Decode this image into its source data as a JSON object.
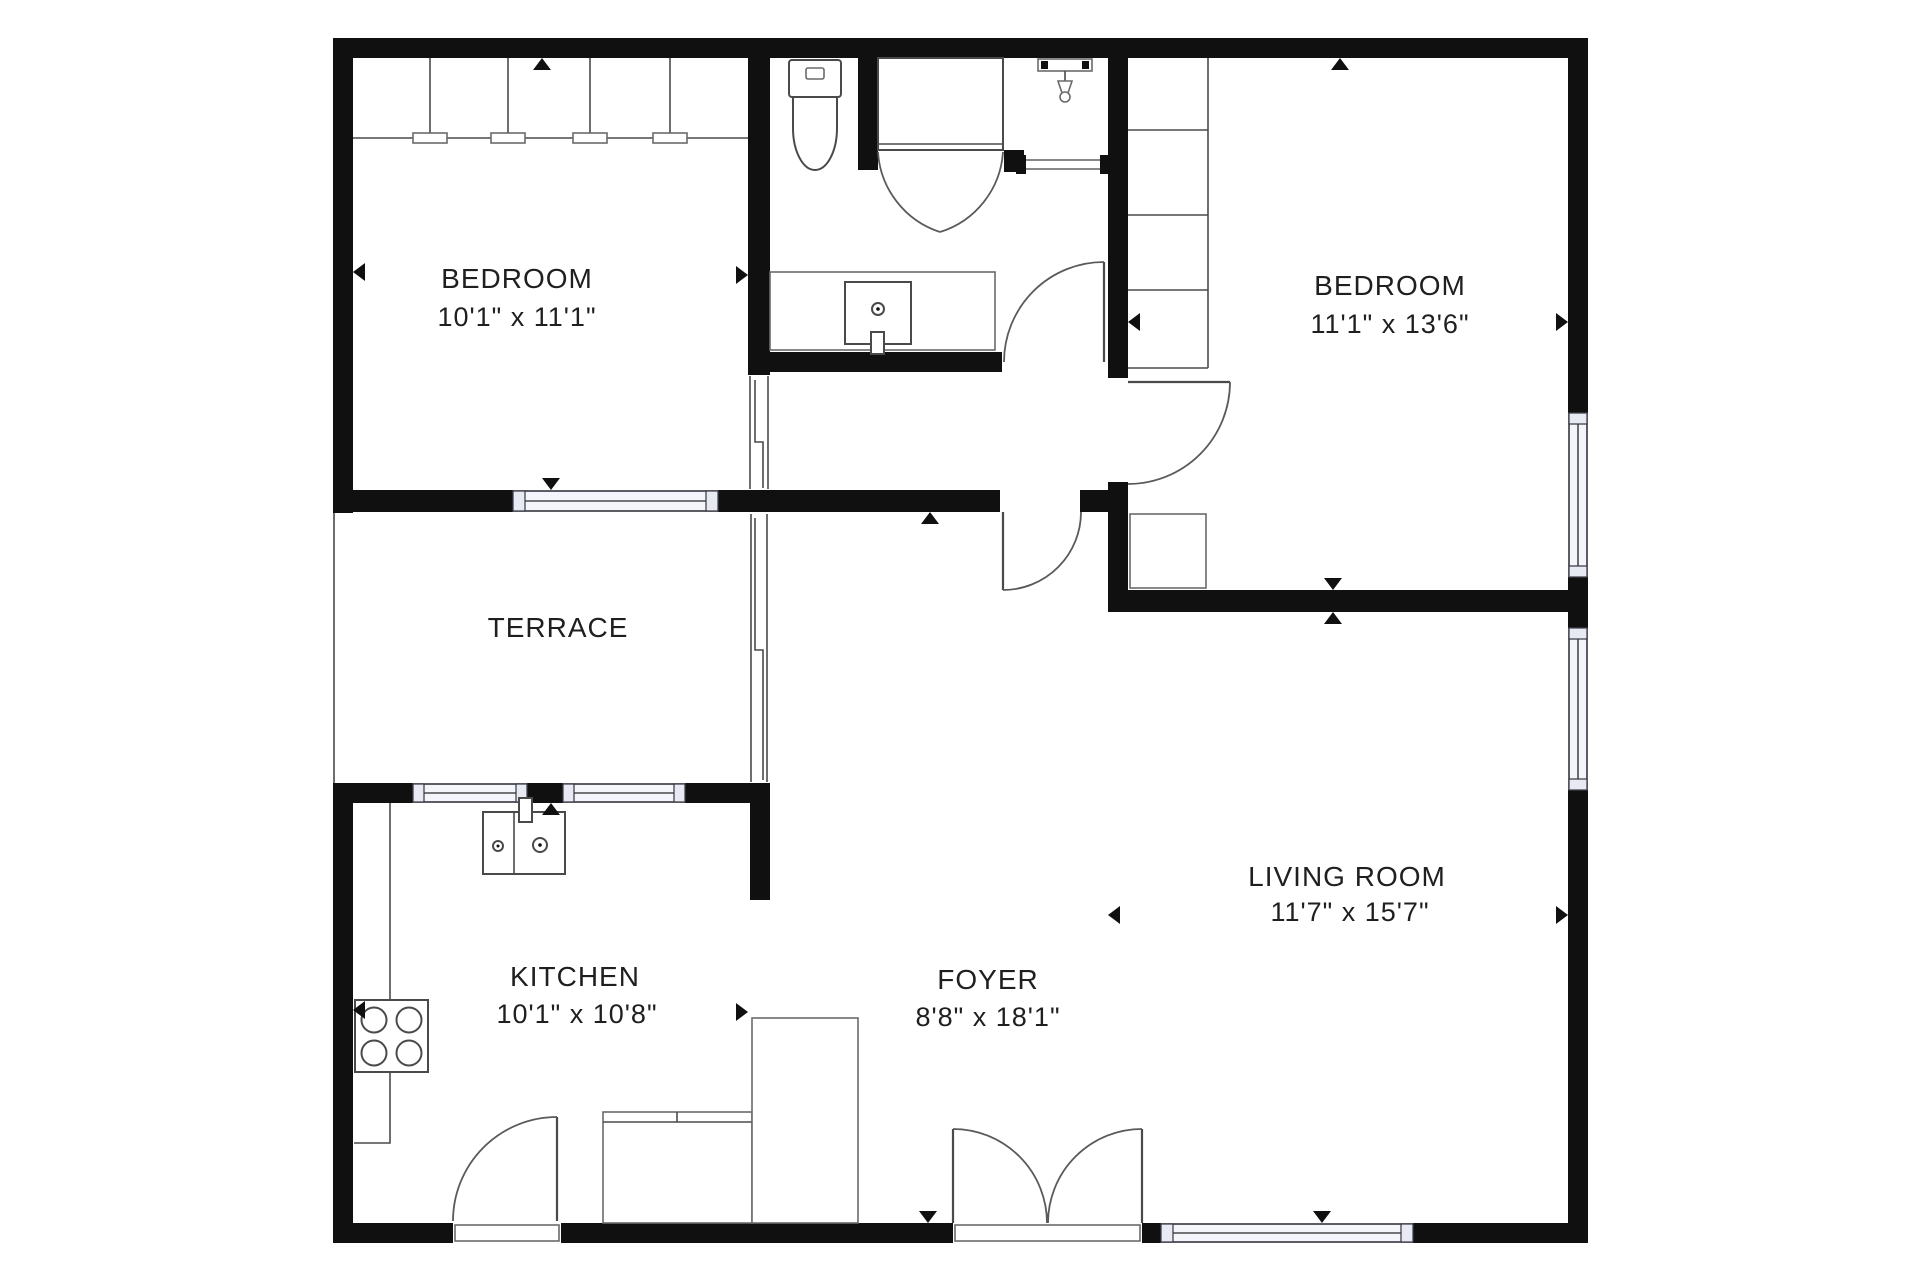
{
  "plan": {
    "title": "Apartment floor plan",
    "rooms": [
      {
        "id": "bedroom-1",
        "name": "BEDROOM",
        "dims": "10'1\" x 11'1\""
      },
      {
        "id": "bedroom-2",
        "name": "BEDROOM",
        "dims": "11'1\" x 13'6\""
      },
      {
        "id": "terrace",
        "name": "TERRACE",
        "dims": ""
      },
      {
        "id": "kitchen",
        "name": "KITCHEN",
        "dims": "10'1\" x 10'8\""
      },
      {
        "id": "foyer",
        "name": "FOYER",
        "dims": "8'8\" x 18'1\""
      },
      {
        "id": "living-room",
        "name": "LIVING ROOM",
        "dims": "11'7\" x 15'7\""
      }
    ],
    "colors": {
      "wall": "#101010",
      "line": "#4a4a4a",
      "window_glass": "#f3f5fa",
      "background": "#ffffff",
      "text": "#1f1f1f"
    }
  }
}
